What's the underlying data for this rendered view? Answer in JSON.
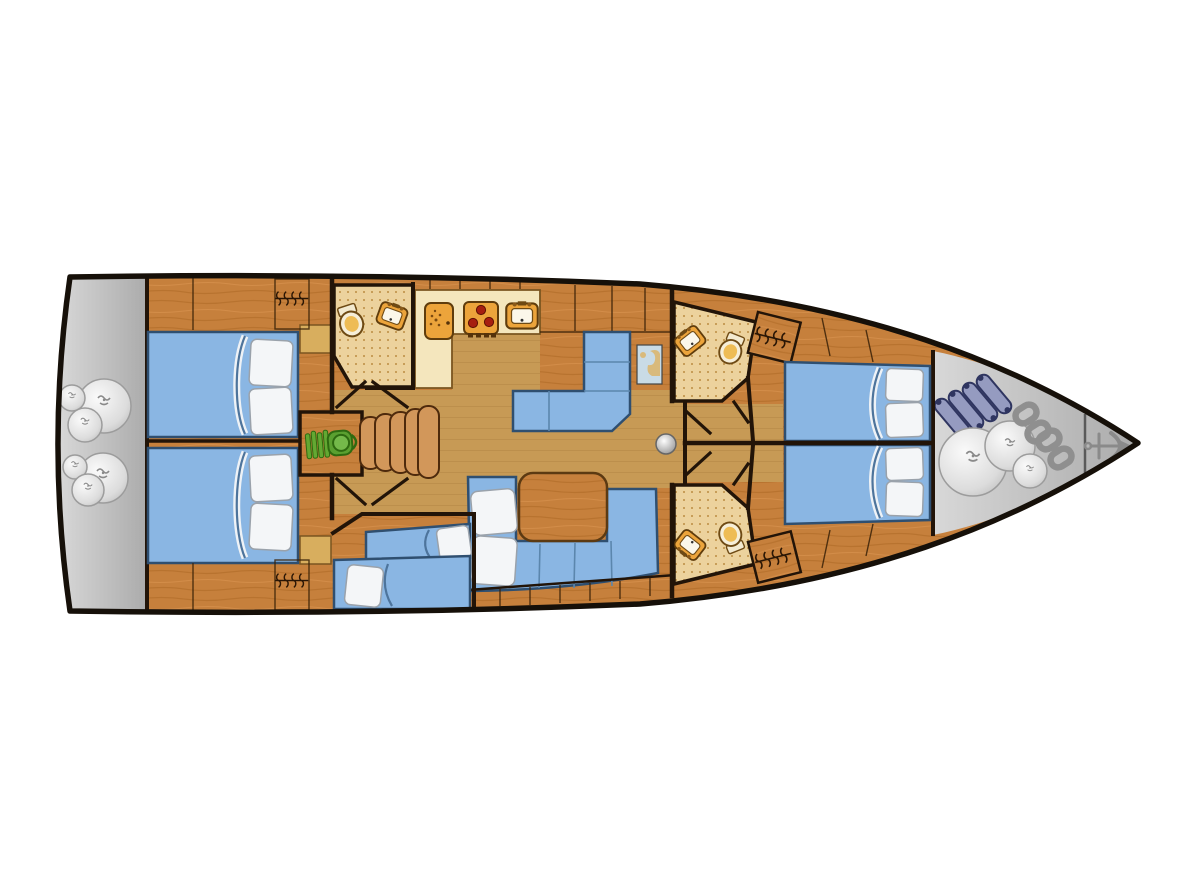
{
  "title": "Sailing yacht interior floor plan",
  "diagram": {
    "type": "yacht-floor-plan",
    "description": "Top-down deck layout of a sailing yacht: stern platform, two aft double cabins, aft head, companionway with engine room, galley, chart table, saloon, bunk cabin, two forward heads, two forward cabins and bow sail locker",
    "orientation": {
      "bow": "right",
      "stern": "left"
    }
  },
  "colors": {
    "background": "#ffffff",
    "hull-outline": "#161009",
    "wall": "#221408",
    "wood": "#c6803c",
    "wood-grain": "#a35f1b",
    "floor": "#c79a55",
    "floor-line": "#8a5a20",
    "cabinet-line": "#3a2208",
    "galley-cream": "#f4e6bd",
    "counter-edge": "#7a5520",
    "tile": "#ecd29d",
    "tile-dot": "#bc8d42",
    "bed-blue": "#8ab6e3",
    "bed-edge": "#2f4f70",
    "sheet-line": "#4d749c",
    "pillow": "#f4f6f8",
    "pillow-edge": "#9aa2ab",
    "table-wood": "#c07c37",
    "zone-gray": "#bdbdbd",
    "bag-gray": "#d9d9d9",
    "rope-gray": "#8a8a8a",
    "chain-gray": "#8f8f8f",
    "anchor-gray": "#8a8a8a",
    "fender-blue": "#959bc0",
    "fender-dark": "#2f3560",
    "engine-green": "#5aa332",
    "engine-dark": "#2e6a10",
    "appliance-amber": "#eca43b",
    "appliance-outline": "#5f3c0c",
    "burner-red": "#a61f10",
    "basin-white": "#fbf7ea",
    "map-water": "#c9dbe6",
    "map-land": "#d9ba7c",
    "nightstand": "#d8ae5e",
    "mast-gray": "#9a9a9a"
  },
  "rooms": {
    "stern_platform": {
      "name": "Stern platform / lazarette with sail bags"
    },
    "aft_cabin_port": {
      "name": "Aft double cabin port with hanging locker"
    },
    "aft_cabin_starboard": {
      "name": "Aft double cabin starboard with hanging locker"
    },
    "aft_head": {
      "name": "Aft bathroom with toilet and washbasin"
    },
    "engine_room": {
      "name": "Engine compartment"
    },
    "companionway": {
      "name": "Companionway steps"
    },
    "galley": {
      "name": "Galley with fridge, stove and sink"
    },
    "nav_station": {
      "name": "Chart table with L-shaped settee"
    },
    "saloon": {
      "name": "Saloon with U-shaped settee and table"
    },
    "bunk_cabin": {
      "name": "Bunk cabin with two berths"
    },
    "head_forward_port": {
      "name": "Forward bathroom port with toilet and washbasin"
    },
    "head_forward_starboard": {
      "name": "Forward bathroom starboard with toilet and washbasin"
    },
    "forward_cabin_port": {
      "name": "Forward cabin port with single berth and hanging locker"
    },
    "forward_cabin_starboard": {
      "name": "Forward cabin starboard with single berth and hanging locker"
    },
    "sail_locker": {
      "name": "Bow sail locker with fenders, sail bags, anchor chain and anchor"
    },
    "mast": {
      "name": "Mast compression post"
    }
  }
}
